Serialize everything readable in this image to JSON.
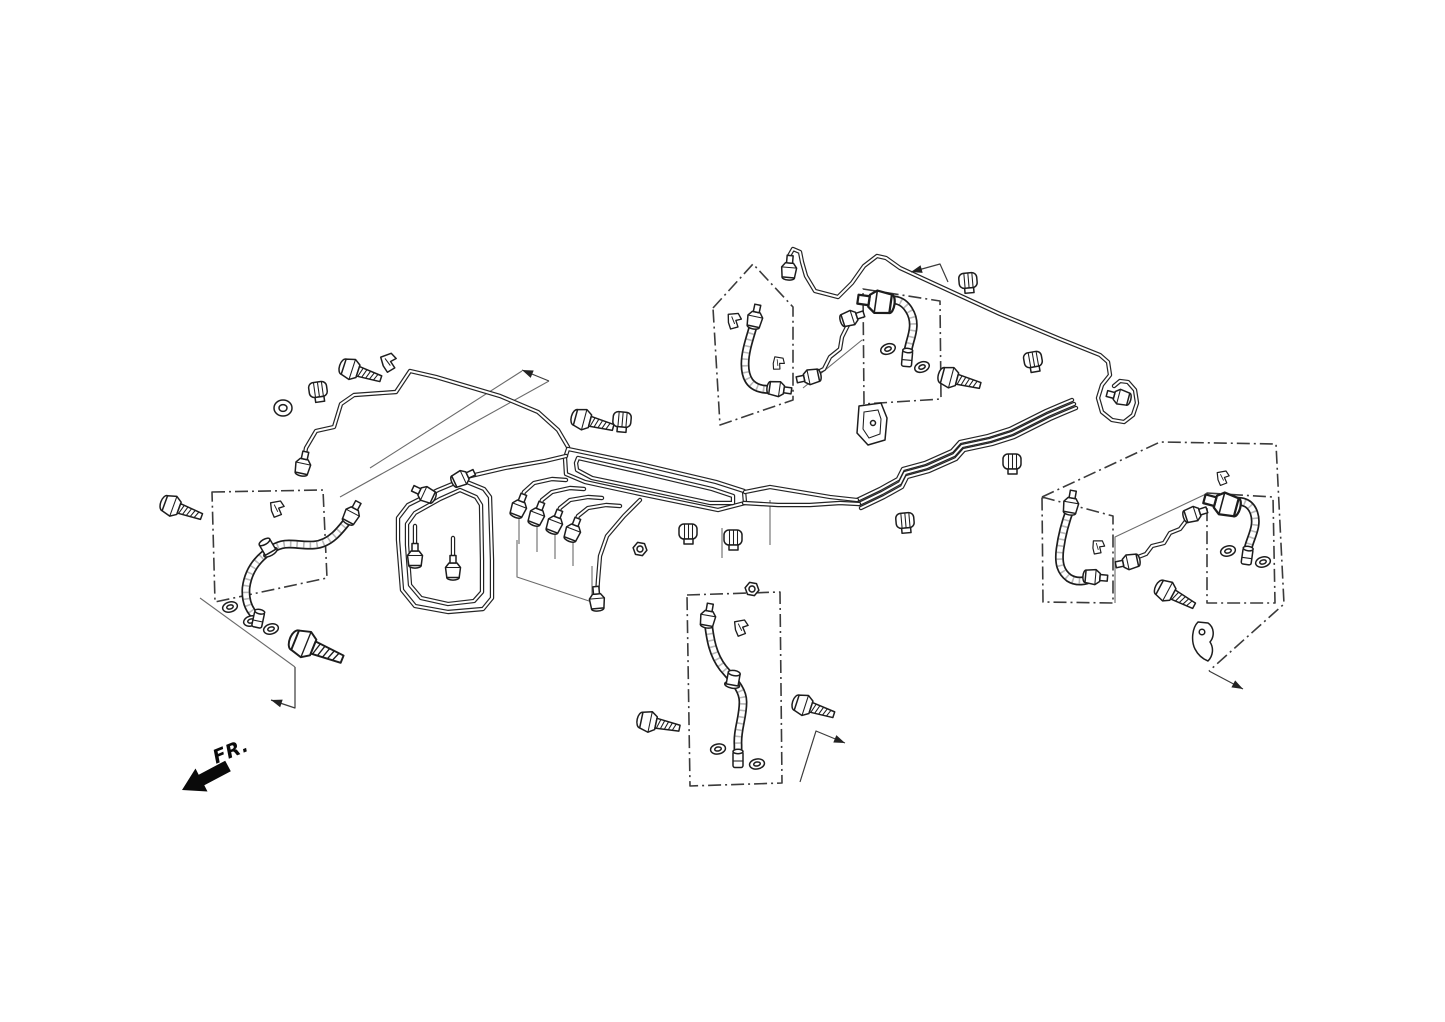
{
  "meta": {
    "background": "#ffffff",
    "ink": "#1d1d1d",
    "construction_color": "#6a6a6a"
  },
  "fr_indicator": {
    "label": "FR.",
    "text_x": 233,
    "text_y": 757,
    "text_angle": -22,
    "arrow_points": "182,790 195.5,768.5 198.7,774.7 225.2,760.7 230.8,771.3 204.3,785.3 207.5,791.5"
  },
  "diagram": {
    "group_boxes": [
      {
        "n": "front-left-hose-group-box",
        "p": "212,492 323,490 327,578 215,602",
        "closed": true
      },
      {
        "n": "center-rear-hose-group-box",
        "p": "687,595 780,592 782,783 690,786",
        "closed": true
      },
      {
        "n": "mid-left-hose-group-box",
        "p": "713,308 753,264 793,307 793,400 720,425",
        "closed": true
      },
      {
        "n": "mid-right-hose-group-box",
        "p": "863,289 940,301 941,399 864,404",
        "closed": true
      },
      {
        "n": "right-inner-hose-group-box",
        "p": "1042,497 1113,516 1113,603 1043,602",
        "closed": true
      },
      {
        "n": "right-outer-hose-group-box",
        "p": "1207,493 1273,497 1275,603 1207,603",
        "closed": true
      },
      {
        "n": "right-group-outline",
        "p": "1042,497 1160,442 1276,444 1284,604 1209,671",
        "closed": false
      }
    ],
    "construction_lines": [
      {
        "n": "leader-line",
        "p": "200,598 295,667"
      },
      {
        "n": "leader-line",
        "p": "549,381 340,497"
      },
      {
        "n": "leader-line",
        "p": "522,371 370,468"
      },
      {
        "n": "leader-line",
        "p": "517,540 517,577 592,602 592,566"
      },
      {
        "n": "leader-line",
        "p": "519,510 519,544"
      },
      {
        "n": "leader-line",
        "p": "537,518 537,552"
      },
      {
        "n": "leader-line",
        "p": "555,525 555,559"
      },
      {
        "n": "leader-line",
        "p": "573,532 573,566"
      },
      {
        "n": "leader-line",
        "p": "803,388 862,340"
      },
      {
        "n": "leader-line",
        "p": "1115,603 1115,537 1206,494"
      },
      {
        "n": "leader-line",
        "p": "770,500 770,545"
      },
      {
        "n": "leader-line",
        "p": "722,528 722,558"
      }
    ],
    "pipes": [
      {
        "n": "front-left-brake-pipe",
        "p": "303,464 306,448 316,431 334,427 341,404 354,395 396,392 410,371 436,377 500,396 538,412 558,430 568,447",
        "closed": false
      },
      {
        "n": "rear-upper-brake-pipe",
        "p": "789,268 789,256 793,249 800,252 802,262 806,276 815,291 838,297 852,283 864,266 877,256 886,258 900,268 1000,314 1060,339 1100,355 1108,362 1110,375 1102,385 1098,398 1102,412 1112,420 1124,422 1133,415 1137,403 1135,390 1128,382 1120,381 1114,386",
        "closed": false
      },
      {
        "n": "rear-pipe-bundle-1",
        "p": "857,500 880,489 898,479 903,469 925,463 952,451 960,442 988,436 1010,429 1032,418 1046,411 1060,405 1072,400",
        "closed": false
      },
      {
        "n": "rear-pipe-bundle-2",
        "p": "859,504 882,493 900,483 905,473 927,467 954,455 962,446 990,440 1012,433 1034,422 1048,415 1062,409 1074,404",
        "closed": false
      },
      {
        "n": "rear-pipe-bundle-3",
        "p": "861,508 884,497 902,487 907,477 929,471 956,459 964,450 992,444 1014,437 1036,426 1050,419 1064,413 1076,408",
        "closed": false
      },
      {
        "n": "center-pipe-loop-outer",
        "p": "568,449 640,464 716,482 744,491 745,503 718,510 645,495 585,482 566,474 565,458",
        "closed": true
      },
      {
        "n": "center-pipe-loop-inner",
        "p": "578,458 640,472 712,489 733,496 733,503 710,503 645,489 592,478 577,470 576,463",
        "closed": true
      },
      {
        "n": "center-loop-exit-upper",
        "p": "745,492 770,487 800,492 830,497 857,500",
        "closed": false
      },
      {
        "n": "center-loop-exit-lower",
        "p": "744,503 778,505 810,505 840,503 859,504",
        "closed": false
      },
      {
        "n": "master-cylinder-pipe-1",
        "p": "519,505 524,492 534,483 552,479 566,480",
        "closed": false
      },
      {
        "n": "master-cylinder-pipe-2",
        "p": "537,513 542,500 552,492 570,488 584,489",
        "closed": false
      },
      {
        "n": "master-cylinder-pipe-3",
        "p": "555,521 560,508 570,500 588,497 602,498",
        "closed": false
      },
      {
        "n": "master-cylinder-pipe-4",
        "p": "573,529 578,516 588,508 606,505 620,506",
        "closed": false
      },
      {
        "n": "left-pipe-loop-outer",
        "p": "462,480 484,489 490,497 492,560 492,598 483,609 448,612 415,606 402,590 398,540 398,518 408,505 438,490",
        "closed": true
      },
      {
        "n": "left-pipe-loop-inner",
        "p": "460,490 476,497 481,505 482,560 482,592 474,601 448,604 421,598 410,585 407,545 407,524 415,513 440,499",
        "closed": true
      },
      {
        "n": "left-loop-stub-1",
        "p": "415,555 415,526",
        "closed": false
      },
      {
        "n": "left-loop-stub-2",
        "p": "453,567 453,538",
        "closed": false
      },
      {
        "n": "left-loop-link-pipe",
        "p": "462,478 505,468 545,461 566,456",
        "closed": false
      },
      {
        "n": "center-down-pipe",
        "p": "640,500 624,516 607,536 600,556 598,580 597,596",
        "closed": false
      },
      {
        "n": "mid-link-pipe",
        "p": "812,375 824,369 830,357 840,349 842,337 848,325 850,319",
        "closed": false
      },
      {
        "n": "right-link-pipe",
        "p": "1130,560 1146,554 1152,546 1164,543 1170,533 1180,529 1186,521 1192,516",
        "closed": false
      }
    ],
    "hoses": [
      {
        "n": "front-left-brake-hose",
        "d": "M 352,515 C 340,531 330,544 314,545 C 296,546 286,540 272,549 C 256,559 248,572 246,588 C 245,603 250,612 258,618"
      },
      {
        "n": "mid-left-brake-hose",
        "d": "M 755,320 C 751,335 745,350 745,364 C 745,379 751,387 763,389 C 770,390 775,389 778,388"
      },
      {
        "n": "mid-right-brake-hose",
        "d": "M 881,303 C 893,297 903,300 909,310 C 916,321 913,332 910,342 C 908,350 907,353 907,357"
      },
      {
        "n": "center-rear-brake-hose",
        "d": "M 708,620 C 710,640 713,655 723,668 C 735,682 743,690 743,702 C 743,718 737,730 738,745 C 738,752 738,756 738,758"
      },
      {
        "n": "right-inner-brake-hose",
        "d": "M 1071,507 C 1066,520 1062,534 1060,549 C 1058,564 1061,572 1069,578 C 1077,583 1086,581 1092,578"
      },
      {
        "n": "right-outer-brake-hose",
        "d": "M 1225,505 C 1238,498 1250,501 1254,513 C 1258,525 1252,535 1249,545 C 1247,551 1247,553 1247,556"
      }
    ],
    "parts": [
      {
        "t": "bolt",
        "x": 178,
        "y": 508,
        "a": 20
      },
      {
        "t": "banjo-bolt",
        "x": 312,
        "y": 647,
        "a": 22
      },
      {
        "t": "bolt",
        "x": 357,
        "y": 371,
        "a": 18
      },
      {
        "t": "bolt",
        "x": 589,
        "y": 421,
        "a": 15
      },
      {
        "t": "bolt",
        "x": 956,
        "y": 379,
        "a": 15
      },
      {
        "t": "bolt",
        "x": 655,
        "y": 723,
        "a": 12
      },
      {
        "t": "bolt",
        "x": 810,
        "y": 707,
        "a": 18
      },
      {
        "t": "bolt",
        "x": 1172,
        "y": 594,
        "a": 28
      },
      {
        "t": "washer",
        "x": 230,
        "y": 607,
        "a": -15
      },
      {
        "t": "washer",
        "x": 251,
        "y": 621,
        "a": -15
      },
      {
        "t": "washer",
        "x": 271,
        "y": 629,
        "a": -15
      },
      {
        "t": "washer",
        "x": 718,
        "y": 749,
        "a": -10
      },
      {
        "t": "washer",
        "x": 757,
        "y": 764,
        "a": -10
      },
      {
        "t": "washer",
        "x": 888,
        "y": 349,
        "a": -20
      },
      {
        "t": "washer",
        "x": 922,
        "y": 367,
        "a": -20
      },
      {
        "t": "washer",
        "x": 1228,
        "y": 551,
        "a": -15
      },
      {
        "t": "washer",
        "x": 1263,
        "y": 562,
        "a": -15
      },
      {
        "t": "grommet",
        "x": 283,
        "y": 408,
        "a": 0
      },
      {
        "t": "nut",
        "x": 640,
        "y": 549,
        "a": 10
      },
      {
        "t": "nut",
        "x": 752,
        "y": 589,
        "a": 10
      },
      {
        "t": "collar",
        "x": 268,
        "y": 548,
        "a": -30
      },
      {
        "t": "collar",
        "x": 733,
        "y": 680,
        "a": 10
      },
      {
        "t": "clip",
        "x": 276,
        "y": 510,
        "a": 0,
        "s": 0.9
      },
      {
        "t": "clip",
        "x": 388,
        "y": 364,
        "a": -10
      },
      {
        "t": "clip",
        "x": 733,
        "y": 322,
        "a": 5,
        "s": 0.9
      },
      {
        "t": "clip",
        "x": 777,
        "y": 364,
        "a": 20,
        "s": 0.75
      },
      {
        "t": "clip",
        "x": 740,
        "y": 629,
        "a": 0,
        "s": 0.9
      },
      {
        "t": "clip",
        "x": 1097,
        "y": 548,
        "a": 10,
        "s": 0.8
      },
      {
        "t": "clip",
        "x": 1222,
        "y": 479,
        "a": 0,
        "s": 0.8
      },
      {
        "t": "clamp",
        "x": 318,
        "y": 390,
        "a": -8
      },
      {
        "t": "clamp",
        "x": 622,
        "y": 420,
        "a": 5
      },
      {
        "t": "clamp",
        "x": 688,
        "y": 532,
        "a": 0
      },
      {
        "t": "clamp",
        "x": 733,
        "y": 538,
        "a": 0
      },
      {
        "t": "clamp",
        "x": 905,
        "y": 521,
        "a": -5
      },
      {
        "t": "clamp",
        "x": 1012,
        "y": 462,
        "a": 0
      },
      {
        "t": "clamp",
        "x": 1033,
        "y": 360,
        "a": -10
      },
      {
        "t": "clamp",
        "x": 968,
        "y": 281,
        "a": -5
      },
      {
        "t": "bracket-plate",
        "x": 872,
        "y": 426,
        "a": 0
      },
      {
        "t": "bracket-hook",
        "x": 1205,
        "y": 641,
        "a": 0
      },
      {
        "t": "fitting",
        "x": 303,
        "y": 465,
        "a": -78
      },
      {
        "t": "fitting",
        "x": 519,
        "y": 507,
        "a": -69
      },
      {
        "t": "fitting",
        "x": 537,
        "y": 515,
        "a": -69
      },
      {
        "t": "fitting",
        "x": 555,
        "y": 523,
        "a": -69
      },
      {
        "t": "fitting",
        "x": 573,
        "y": 531,
        "a": -69
      },
      {
        "t": "fitting",
        "x": 425,
        "y": 494,
        "a": -155
      },
      {
        "t": "fitting",
        "x": 462,
        "y": 478,
        "a": -25
      },
      {
        "t": "fitting",
        "x": 415,
        "y": 557,
        "a": -90
      },
      {
        "t": "fitting",
        "x": 453,
        "y": 569,
        "a": -90
      },
      {
        "t": "fitting",
        "x": 597,
        "y": 600,
        "a": -95
      },
      {
        "t": "fitting",
        "x": 789,
        "y": 269,
        "a": -85
      },
      {
        "t": "fitting",
        "x": 1120,
        "y": 397,
        "a": -165
      },
      {
        "t": "fitting",
        "x": 810,
        "y": 377,
        "a": 168
      },
      {
        "t": "fitting",
        "x": 851,
        "y": 318,
        "a": -18
      },
      {
        "t": "fitting",
        "x": 1129,
        "y": 562,
        "a": 168
      },
      {
        "t": "fitting",
        "x": 1194,
        "y": 514,
        "a": -18
      },
      {
        "t": "fitting",
        "x": 352,
        "y": 514,
        "a": -62
      },
      {
        "t": "hose-end",
        "x": 258,
        "y": 620,
        "a": 12
      },
      {
        "t": "fitting",
        "x": 755,
        "y": 318,
        "a": -78
      },
      {
        "t": "fitting",
        "x": 778,
        "y": 389,
        "a": 8
      },
      {
        "t": "fitting-big",
        "x": 878,
        "y": 302,
        "a": 188
      },
      {
        "t": "hose-end",
        "x": 907,
        "y": 359,
        "a": 5
      },
      {
        "t": "fitting",
        "x": 708,
        "y": 617,
        "a": -80
      },
      {
        "t": "hose-end",
        "x": 738,
        "y": 760,
        "a": 0
      },
      {
        "t": "fitting",
        "x": 1071,
        "y": 504,
        "a": -80
      },
      {
        "t": "fitting",
        "x": 1094,
        "y": 577,
        "a": 5
      },
      {
        "t": "fitting-big",
        "x": 1224,
        "y": 504,
        "a": 195
      },
      {
        "t": "hose-end",
        "x": 1247,
        "y": 557,
        "a": 8
      }
    ],
    "leader_arrows": [
      {
        "n": "leader-arrow",
        "p": "295,667 295,708 271,700"
      },
      {
        "n": "leader-arrow",
        "p": "549,381 522,370"
      },
      {
        "n": "leader-arrow",
        "p": "948,282 940,264 911,272"
      },
      {
        "n": "leader-arrow",
        "p": "800,782 816,731 845,743"
      },
      {
        "n": "leader-arrow",
        "p": "1209,671 1243,689"
      }
    ]
  }
}
